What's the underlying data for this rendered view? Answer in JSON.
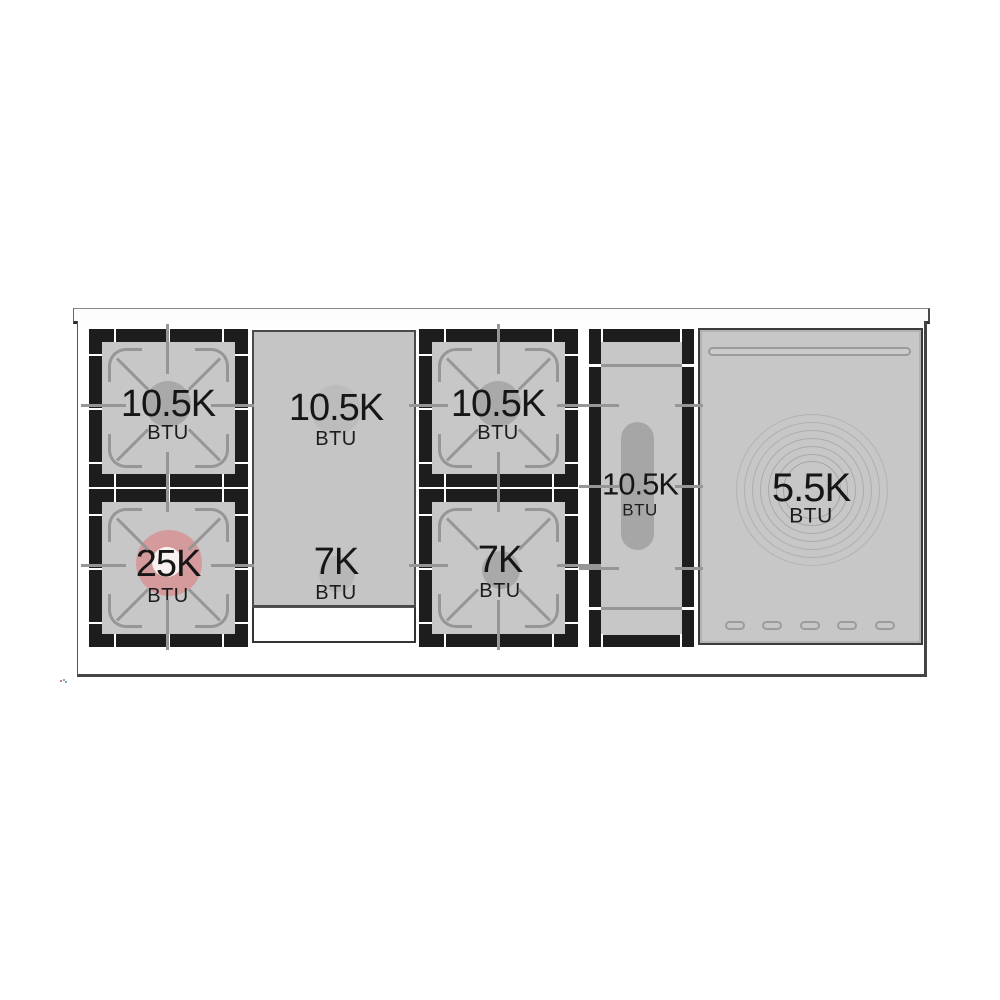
{
  "sections": [
    {
      "name": "left-burner-pair",
      "burners": [
        {
          "value": "10.5K",
          "unit": "BTU"
        },
        {
          "value": "25K",
          "unit": "BTU",
          "highlighted": true
        }
      ]
    },
    {
      "name": "griddle",
      "burners": [
        {
          "value": "10.5K",
          "unit": "BTU"
        },
        {
          "value": "7K",
          "unit": "BTU"
        }
      ]
    },
    {
      "name": "center-burner-pair",
      "burners": [
        {
          "value": "10.5K",
          "unit": "BTU"
        },
        {
          "value": "7K",
          "unit": "BTU"
        }
      ]
    },
    {
      "name": "oval-burner",
      "burners": [
        {
          "value": "10.5K",
          "unit": "BTU"
        }
      ]
    },
    {
      "name": "french-top",
      "burners": [
        {
          "value": "5.5K",
          "unit": "BTU"
        }
      ]
    }
  ],
  "colors": {
    "highlight": "#d59a9c",
    "surface": "#c7c7c7",
    "frame": "#1d1d1d",
    "grate_line": "#969696"
  }
}
